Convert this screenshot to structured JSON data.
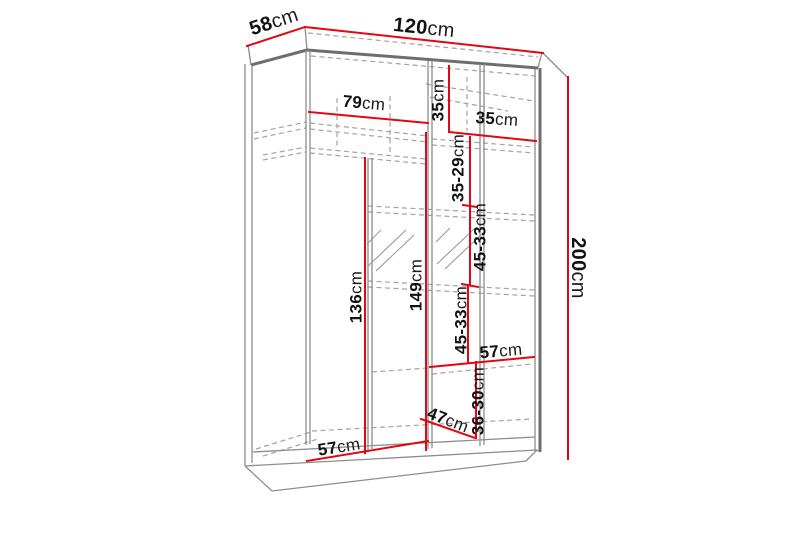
{
  "figure": {
    "type": "furniture-dimension-diagram",
    "subject": "wardrobe carcass in perspective with internal shelf layout",
    "units": "cm",
    "colors": {
      "dimension_line": "#e30613",
      "structure_line": "#8d8d8d",
      "hidden_line": "#a3a3a3",
      "text": "#111111",
      "background": "#ffffff"
    },
    "overall": {
      "width_cm": "120",
      "depth_cm": "58",
      "height_cm": "200"
    },
    "labels": {
      "d58": {
        "num": "58",
        "unit": "cm"
      },
      "d120": {
        "num": "120",
        "unit": "cm"
      },
      "d200": {
        "num": "200",
        "unit": "cm"
      },
      "d79": {
        "num": "79",
        "unit": "cm"
      },
      "d35v": {
        "num": "35",
        "unit": "cm"
      },
      "d35h": {
        "num": "35",
        "unit": "cm"
      },
      "r3529": {
        "num": "35-29",
        "unit": "cm"
      },
      "r4533a": {
        "num": "45-33",
        "unit": "cm"
      },
      "r4533b": {
        "num": "45-33",
        "unit": "cm"
      },
      "r3630": {
        "num": "36-30",
        "unit": "cm"
      },
      "d57r": {
        "num": "57",
        "unit": "cm"
      },
      "d47": {
        "num": "47",
        "unit": "cm"
      },
      "d57b": {
        "num": "57",
        "unit": "cm"
      },
      "d136": {
        "num": "136",
        "unit": "cm"
      },
      "d149": {
        "num": "149",
        "unit": "cm"
      }
    }
  }
}
